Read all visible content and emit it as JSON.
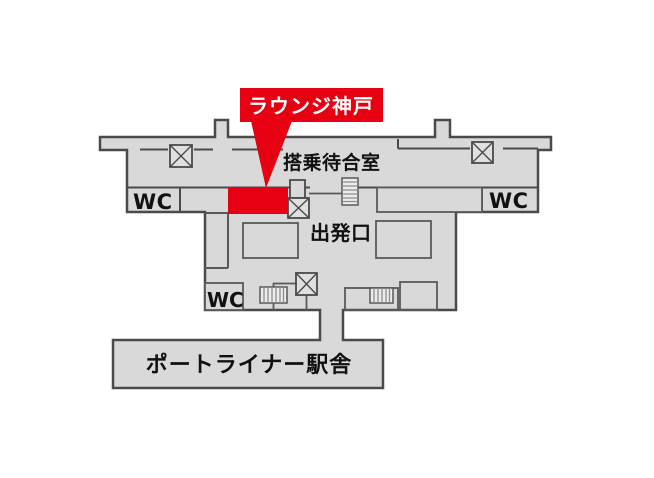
{
  "map": {
    "highlight_label": "ラウンジ神戸",
    "labels": {
      "boarding_room": "搭乗待合室",
      "departure_gate": "出発口",
      "station": "ポートライナー駅舎",
      "wc_upper_left": "WC",
      "wc_upper_right": "WC",
      "wc_lower": "WC"
    },
    "colors": {
      "building_fill": "#d9d9d9",
      "outline": "#4a4a4a",
      "highlight_red": "#e60012",
      "label_text": "#ffffff",
      "map_text": "#111111"
    },
    "icons": {
      "elevator_icons": [
        "elevator-top-left",
        "elevator-top-right",
        "elevator-gate",
        "elevator-lower"
      ],
      "stairs_icons": [
        "stairs-upper",
        "stairs-lower-left",
        "stairs-lower-right"
      ]
    }
  }
}
